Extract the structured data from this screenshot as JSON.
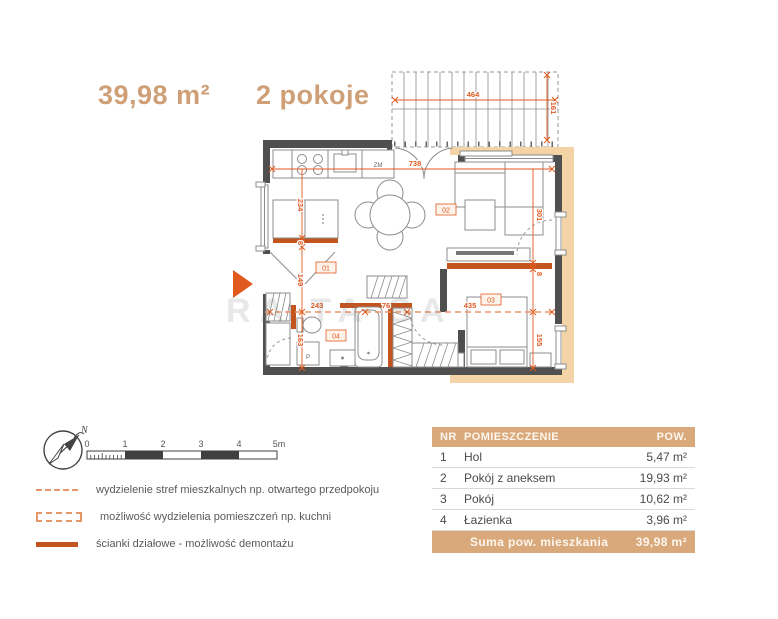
{
  "header": {
    "area": "39,98 m²",
    "rooms": "2 pokoje"
  },
  "plan": {
    "room_labels": {
      "hol": "01",
      "living": "02",
      "bedroom": "03",
      "bath": "04"
    },
    "appliance_labels": {
      "dishwasher": "ZM",
      "washer": "P"
    },
    "dimensions": {
      "top_width": "738",
      "balcony_width": "464",
      "balcony_depth": "161",
      "kitchen_height": "234",
      "wall_left": "8",
      "hall_height": "149",
      "bath_height": "163",
      "hall_width": "243",
      "wardrobe_width": "76",
      "bedroom_width": "435",
      "bedroom_depth": "155",
      "living_depth": "301",
      "wall_right": "8"
    },
    "watermark": "RA TA SA"
  },
  "compass": {
    "north": "N"
  },
  "scalebar": {
    "ticks": [
      "0",
      "1",
      "2",
      "3",
      "4",
      "5m"
    ]
  },
  "legend": {
    "items": [
      {
        "label": "wydzielenie stref mieszkalnych np. otwartego przedpokoju"
      },
      {
        "label": "możliwość wydzielenia pomieszczeń np. kuchni"
      },
      {
        "label": "ścianki działowe - możliwość demontażu"
      }
    ]
  },
  "table": {
    "headers": {
      "nr": "NR",
      "name": "POMIESZCZENIE",
      "area": "POW."
    },
    "rows": [
      {
        "nr": "1",
        "name": "Hol",
        "area": "5,47 m²"
      },
      {
        "nr": "2",
        "name": "Pokój z aneksem",
        "area": "19,93 m²"
      },
      {
        "nr": "3",
        "name": "Pokój",
        "area": "10,62 m²"
      },
      {
        "nr": "4",
        "name": "Łazienka",
        "area": "3,96 m²"
      }
    ],
    "footer": {
      "label": "Suma pow. mieszkania",
      "value": "39,98 m²"
    }
  },
  "colors": {
    "accent_tan": "#d9a97b",
    "dimension_orange": "#e05a20",
    "wall_dark": "#4f4f4f",
    "partition_orange": "#c4541d",
    "exterior_beige": "#f4d4a6"
  }
}
